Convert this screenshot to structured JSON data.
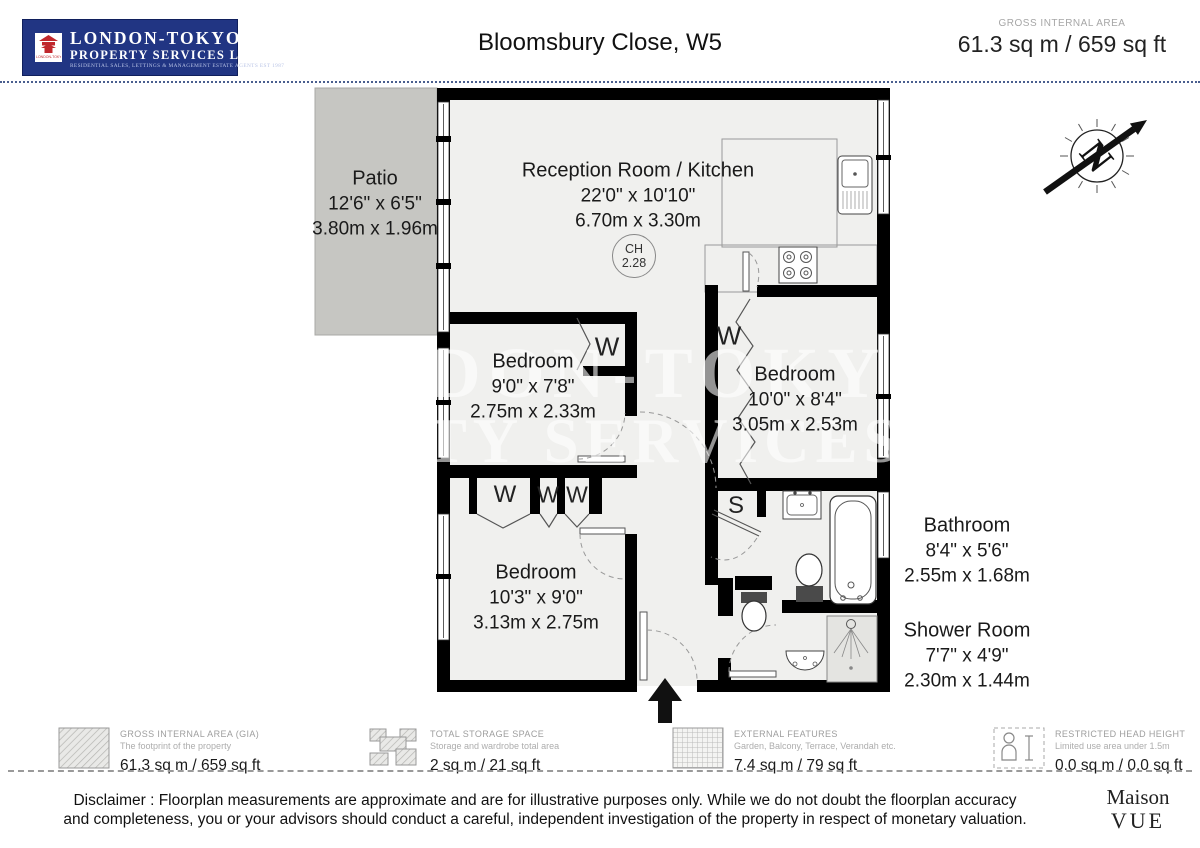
{
  "header": {
    "logo": {
      "line1": "LONDON-TOKYO",
      "line2": "PROPERTY SERVICES LTD.",
      "line3": "RESIDENTIAL SALES, LETTINGS & MANAGEMENT ESTATE AGENTS EST 1987",
      "emblem_caption": "LONDON-TOKYO"
    },
    "title": "Bloomsbury Close, W5",
    "gia_label": "GROSS INTERNAL AREA",
    "gia_value": "61.3 sq m / 659 sq ft"
  },
  "compass_label": "N",
  "watermark": {
    "line1": "LONDON-TOKYO",
    "line2": "PROPERTY SERVICES LTD"
  },
  "rooms": {
    "patio": {
      "name": "Patio",
      "imperial": "12'6\" x 6'5\"",
      "metric": "3.80m x 1.96m"
    },
    "reception": {
      "name": "Reception Room / Kitchen",
      "imperial": "22'0\" x 10'10\"",
      "metric": "6.70m x 3.30m"
    },
    "ceiling_height": {
      "label": "CH",
      "value": "2.28"
    },
    "bedroom_mid": {
      "name": "Bedroom",
      "imperial": "9'0\" x 7'8\"",
      "metric": "2.75m x 2.33m"
    },
    "bedroom_right": {
      "name": "Bedroom",
      "imperial": "10'0\" x 8'4\"",
      "metric": "3.05m x 2.53m"
    },
    "bedroom_bottom": {
      "name": "Bedroom",
      "imperial": "10'3\" x 9'0\"",
      "metric": "3.13m x 2.75m"
    },
    "bathroom": {
      "name": "Bathroom",
      "imperial": "8'4\" x 5'6\"",
      "metric": "2.55m x 1.68m"
    },
    "shower_room": {
      "name": "Shower Room",
      "imperial": "7'7\" x 4'9\"",
      "metric": "2.30m x 1.44m"
    },
    "wardrobe_label": "W",
    "storage_label": "S"
  },
  "legend": [
    {
      "title": "GROSS INTERNAL AREA (GIA)",
      "subtitle": "The footprint of the property",
      "value": "61.3 sq m / 659 sq ft"
    },
    {
      "title": "TOTAL STORAGE SPACE",
      "subtitle": "Storage and wardrobe total area",
      "value": "2 sq m / 21 sq ft"
    },
    {
      "title": "EXTERNAL FEATURES",
      "subtitle": "Garden, Balcony, Terrace, Verandah etc.",
      "value": "7.4 sq m / 79 sq ft"
    },
    {
      "title": "RESTRICTED HEAD HEIGHT",
      "subtitle": "Limited use area under 1.5m",
      "value": "0.0 sq m / 0.0 sq ft"
    }
  ],
  "disclaimer": {
    "line1": "Disclaimer : Floorplan measurements are approximate and are for illustrative purposes only. While we do not doubt the floorplan accuracy",
    "line2": "and completeness, you or your advisors should conduct a careful, independent investigation of the property in respect of monetary valuation."
  },
  "brand": {
    "line1": "Maison",
    "line2": "VUE"
  },
  "colors": {
    "logo_blue": "#213583",
    "wall": "#000000",
    "floor": "#f0f0ee",
    "patio": "#c6c6c2",
    "accent_red": "#c0272d"
  }
}
